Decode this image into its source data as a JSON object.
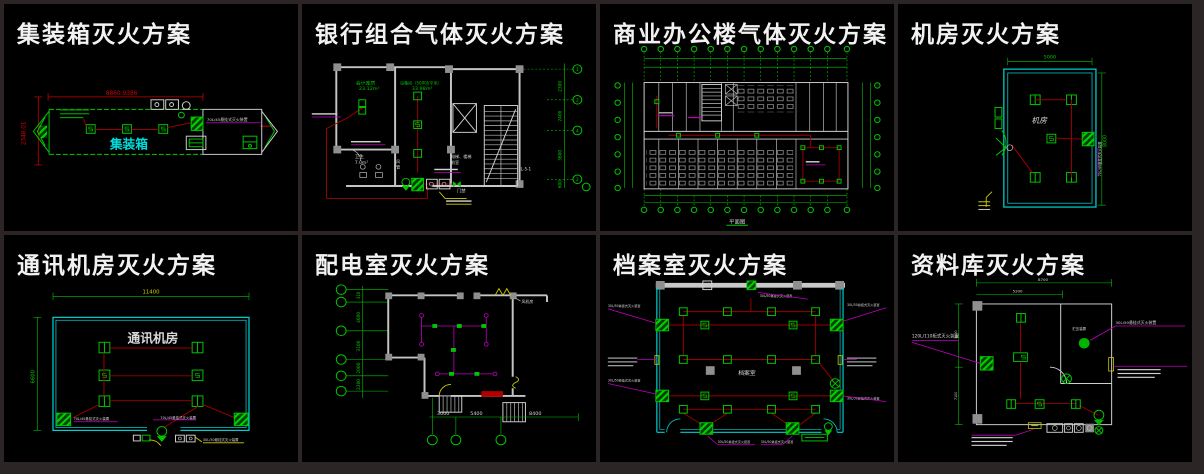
{
  "window": {
    "bg": "#000000",
    "frame": "#2b2525"
  },
  "palette": {
    "green": "#00c800",
    "cyan": "#00cdcd",
    "pipe_red": "#9c0000",
    "dim_red": "#c80000",
    "magenta": "#c000c0",
    "yellow": "#cfcf00",
    "white": "#d8d8d8",
    "wall_gray": "#8f8f8f"
  },
  "panels": [
    {
      "id": "container",
      "title": "集装箱灭火方案",
      "labels": {
        "room": "集装箱",
        "dim_top": "8860.9386",
        "dim_left": "2348.01",
        "device": "70L/45悬挂式灭火装置"
      }
    },
    {
      "id": "bank",
      "title": "银行组合气体灭火方案",
      "labels": {
        "room1": "会计库房",
        "room1_area": "23.12m²",
        "room2": "设备间（5000J/平米）",
        "room2_area": "33.98m²",
        "toilet": "卫生",
        "toilet_area": "7.0m²",
        "duct1": "风",
        "duct2": "管",
        "lobby1": "电梯、楼梯",
        "lobby2": "前室",
        "access": "门禁",
        "stair_mark": "JL-5-1",
        "axis": [
          "1",
          "2",
          "4",
          "2"
        ],
        "dims": [
          "2300",
          "2400",
          "3600",
          "600"
        ]
      }
    },
    {
      "id": "office",
      "title": "商业办公楼气体灭火方案",
      "labels": {
        "caption": "平面图"
      }
    },
    {
      "id": "machine_room",
      "title": "机房灭火方案",
      "labels": {
        "room": "机房",
        "dim_top": "5000",
        "dim_right": "8000",
        "device": "70L/45悬挂式灭火装置"
      }
    },
    {
      "id": "telecom",
      "title": "通讯机房灭火方案",
      "labels": {
        "room": "通讯机房",
        "dim_top": "11400",
        "dim_left": "6600",
        "device_left": "70L/45悬挂式灭火装置",
        "device_right": "70L/45悬挂式灭火装置",
        "device_door": "30L/50悬挂式灭火装置"
      }
    },
    {
      "id": "power_room",
      "title": "配电室灭火方案",
      "labels": {
        "fan_room": "风机房",
        "dims_left": [
          "310",
          "4600",
          "3100",
          "2000",
          "2200"
        ],
        "dims_bottom": [
          "3000",
          "5400",
          "8400"
        ]
      }
    },
    {
      "id": "archive",
      "title": "档案室灭火方案",
      "labels": {
        "room": "档案室",
        "device": "30L/50悬挂式灭火装置"
      }
    },
    {
      "id": "library",
      "title": "资料库灭火方案",
      "labels": {
        "cabinet": "120L/110柜式灭火装置",
        "hanging": "30L/50悬挂式灭火装置",
        "tank": "贮压装置",
        "dim_top": "8700",
        "dim_mid": "5200",
        "dim_left_a": "3000",
        "dim_left_b": "7100"
      }
    }
  ]
}
